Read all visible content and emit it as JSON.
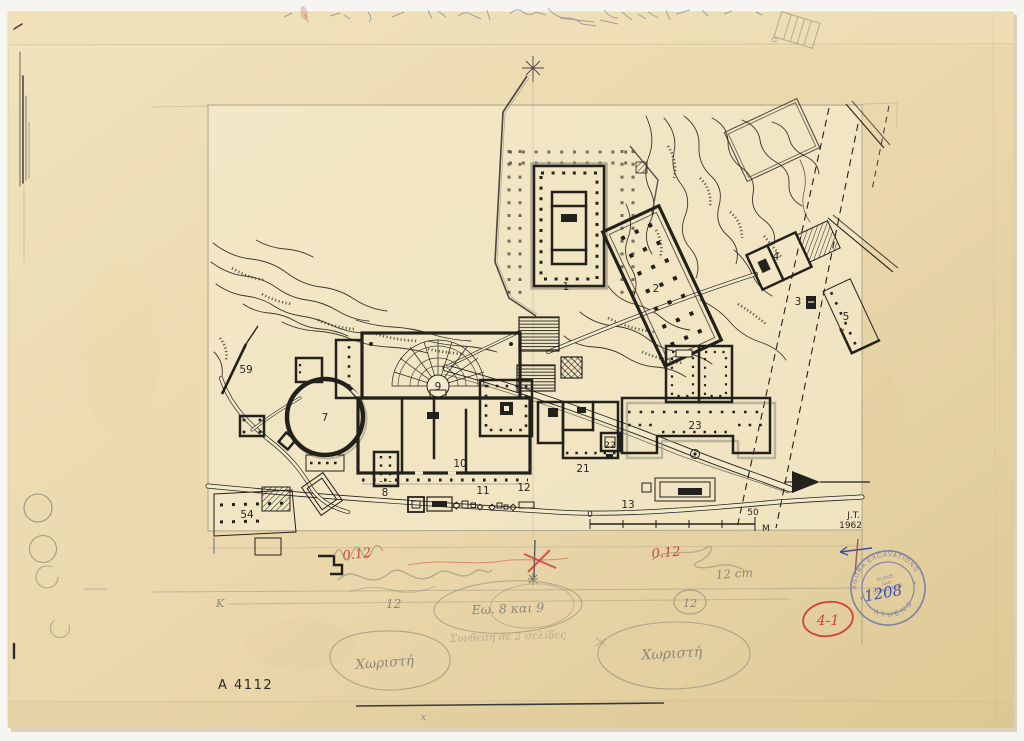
{
  "plan": {
    "labels": {
      "b1": "1",
      "b2": "2",
      "b3": "3",
      "b4": "4",
      "b5": "5",
      "b7": "7",
      "b8": "8",
      "b9": "9",
      "b10": "10",
      "b11": "11",
      "b12": "12",
      "b13": "13",
      "b21": "21",
      "b22": "22",
      "b23": "23",
      "b54": "54",
      "b59": "59"
    },
    "scale_bar": {
      "start": "0",
      "end": "50",
      "unit": "M"
    },
    "credit_initials": "J.T.",
    "credit_year": "1962"
  },
  "annotations": {
    "red_value_left": "0.12",
    "red_value_right": "0.12",
    "pencil_cm": "12 cm",
    "pencil_twelve": "12",
    "circled_twelve": "12",
    "k_mark": "K",
    "ellipse_note": "Εω. 8 και 9",
    "pencil_line_note": "Συνθεση σε 2 σελίδες",
    "separate_note_left": "Χωριστή",
    "separate_note_right": "Χωριστή",
    "red_index": "4-1",
    "catalog_number": "A 4112",
    "tiny_x": "x"
  },
  "stamp": {
    "arc_top": "AGORA EXCAVATIONS",
    "arc_bottom": "ATHENS",
    "star_left": "*",
    "star_right": "*",
    "center_line1": "PLANS",
    "center_line2": "AND",
    "center_line3": "DRAWINGS",
    "number": "1208"
  },
  "colors": {
    "paper": "#ecd9ae",
    "ink": "#23211c",
    "pencil": "#8d8776",
    "red": "#cf4237",
    "stamp": "#7478aa",
    "blue_ink": "#2b3fb5"
  }
}
